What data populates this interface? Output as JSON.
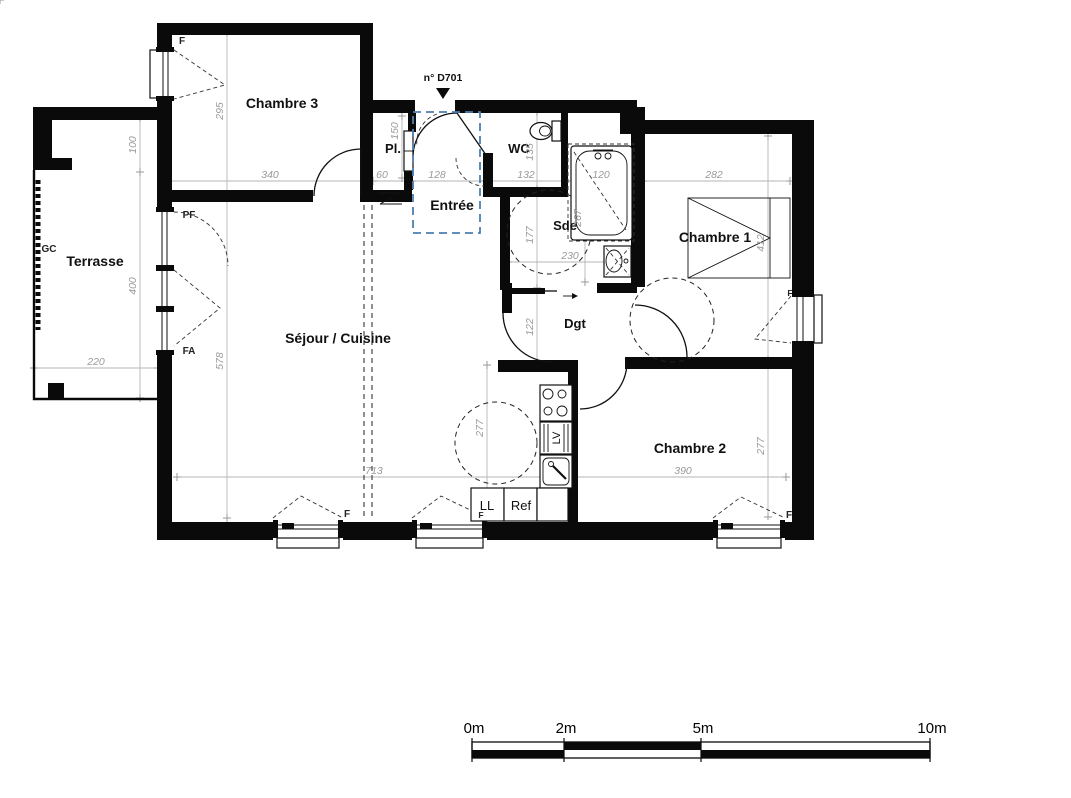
{
  "plan": {
    "door_ref": "n° D701",
    "rooms": {
      "chambre3": "Chambre 3",
      "terrasse": "Terrasse",
      "sejour": "Séjour / Cuisine",
      "entree": "Entrée",
      "placard": "Pl.",
      "wc": "WC",
      "sde": "Sde",
      "dgt": "Dgt",
      "chambre1": "Chambre 1",
      "chambre2": "Chambre 2"
    },
    "dimensions_cm": {
      "d295": "295",
      "d340": "340",
      "d100": "100",
      "d400": "400",
      "d220": "220",
      "d578": "578",
      "d713": "713",
      "d150": "150",
      "d60": "60",
      "d128": "128",
      "d132": "132",
      "d120": "120",
      "d135": "135",
      "d177": "177",
      "d267": "267",
      "d230": "230",
      "d122": "122",
      "d282": "282",
      "d412": "412",
      "d390": "390",
      "d277_kitchen": "277",
      "d277_chambre2": "277"
    },
    "openings": {
      "window_chambre3": "F",
      "porte_fenetre": "PF",
      "fenetre_terrasse": "FA",
      "garde_corps": "GC",
      "window_sejour_1": "F",
      "window_sejour_2": "F",
      "window_chambre1": "F",
      "window_chambre2": "F"
    },
    "appliances": {
      "lave_linge": "LL",
      "refrigerateur": "Ref",
      "lave_vaisselle": "LV"
    },
    "colors": {
      "wall": "#0a0a0a",
      "dimension": "#9a9a9a",
      "entry_highlight": "#4d7fb2",
      "background": "#ffffff"
    }
  },
  "scale_bar": {
    "labels": [
      "0m",
      "2m",
      "5m",
      "10m"
    ]
  }
}
